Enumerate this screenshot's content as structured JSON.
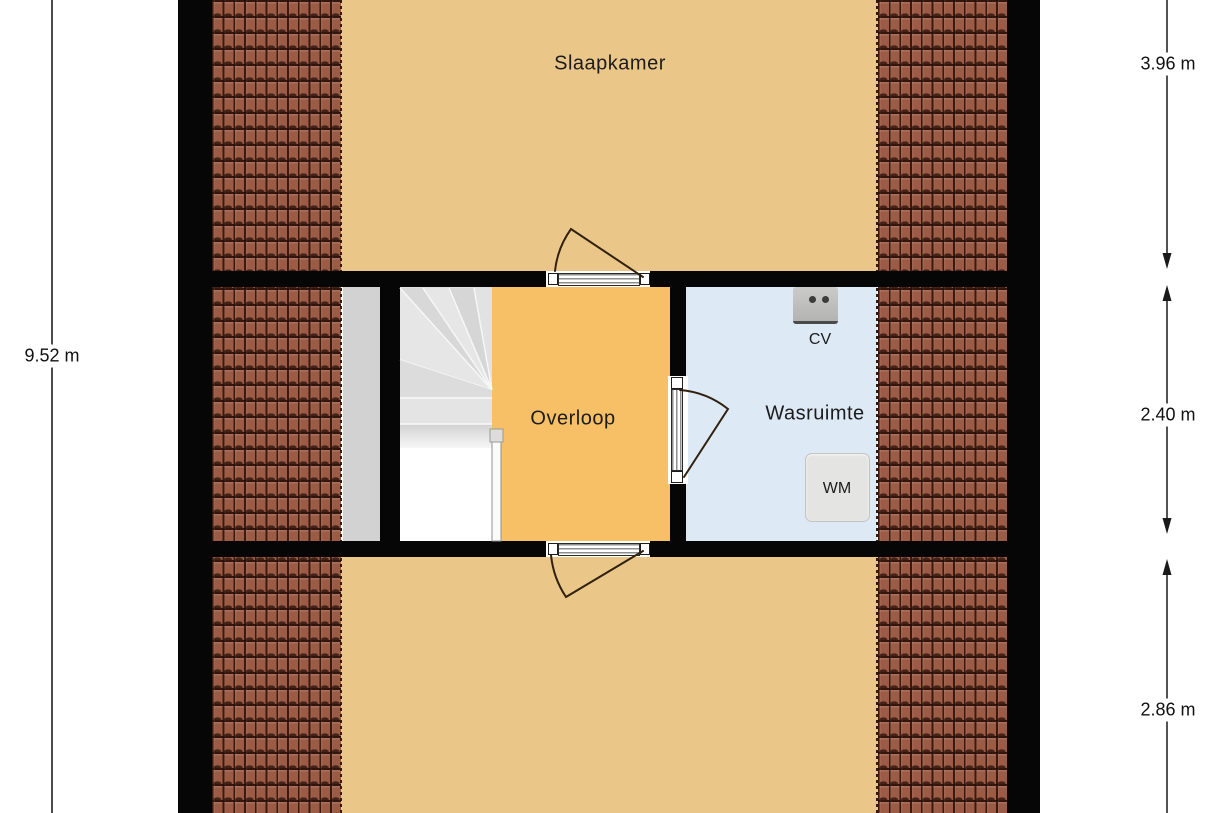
{
  "plan": {
    "type": "floorplan",
    "rooms": {
      "slaapkamer": {
        "label": "Slaapkamer",
        "color": "#ebc689"
      },
      "overloop": {
        "label": "Overloop",
        "color": "#f8c066"
      },
      "wasruimte": {
        "label": "Wasruimte",
        "color": "#dde9f5"
      },
      "onbenoemd_beneden": {
        "label": "",
        "color": "#ebc689"
      }
    },
    "fixtures": {
      "cv": {
        "label": "CV"
      },
      "wm": {
        "label": "WM"
      }
    },
    "dimensions": {
      "left_total": {
        "label": "9.52 m"
      },
      "right": [
        {
          "label": "3.96 m"
        },
        {
          "label": "2.40 m"
        },
        {
          "label": "2.86 m"
        }
      ]
    },
    "colors": {
      "wall": "#060606",
      "roof_tiles": "#9c5b45",
      "tile_grout": "#2b120a",
      "stairs": "#e0e0e0",
      "landing_strip": "#d2d2d2",
      "dimension_line": "#1a1a1a"
    }
  }
}
